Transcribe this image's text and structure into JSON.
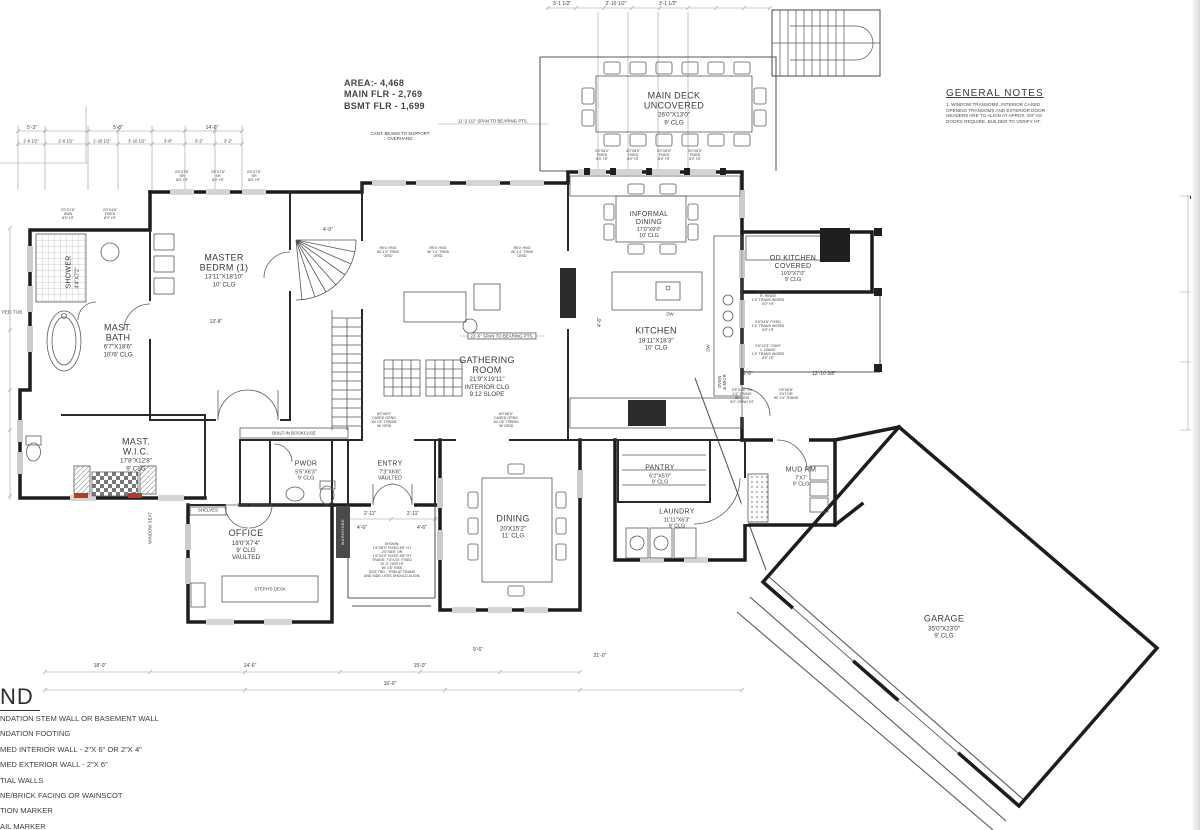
{
  "page": {
    "background": "#ffffff",
    "line_color": "#2e2e2e",
    "accent_red": "#c0392b"
  },
  "area_summary": {
    "text": "AREA:- 4,468\nMAIN FLR - 2,769\nBSMT FLR - 1,699"
  },
  "general_notes": {
    "title": "GENERAL NOTES",
    "items": [
      "1.   WINDOW TRANSOMS, INTERIOR CASED\nOPENING TRANSOMS AND EXTERIOR DOOR\nHEADERS ARE TO ALIGN AT APROX. 8'0\" AS\nDOORS REQUIRE.  BUILDER TO VERIFY HT."
    ]
  },
  "legend": {
    "title": "ND",
    "items": [
      "NDATION STEM WALL OR BASEMENT WALL",
      "NDATION FOOTING",
      "MED INTERIOR WALL - 2\"X 6\" OR 2\"X 4\"",
      "MED EXTERIOR WALL - 2\"X 6\"",
      "TIAL WALLS",
      "NE/BRICK FACING OR WAINSCOT",
      "TION MARKER",
      "AIL MARKER",
      "S SENSOR AND POWERED VENT"
    ]
  },
  "rooms": [
    {
      "id": "master-bedrm",
      "name": "MASTER\nBEDRM (1)",
      "sub": "13'11\"X18'10\"\n10' CLG"
    },
    {
      "id": "shower",
      "name": "SHOWER",
      "sub": "4'4\"X7'2\""
    },
    {
      "id": "mast-bath",
      "name": "MAST.\nBATH",
      "sub": "6'7\"X18'6\"\n10'/9' CLG"
    },
    {
      "id": "mast-wic",
      "name": "MAST.\nW.I.C.",
      "sub": "17'8\"X12'8\"\n9' CLG"
    },
    {
      "id": "office",
      "name": "OFFICE",
      "sub": "18'0\"X7'4\"\n9' CLG\nVAULTED"
    },
    {
      "id": "pwdr",
      "name": "PWDR",
      "sub": "5'5\"X6'3\"\n9' CLG"
    },
    {
      "id": "entry",
      "name": "ENTRY",
      "sub": "7'3\"X6'8\"\nVAULTED"
    },
    {
      "id": "gathering-room",
      "name": "GATHERING\nROOM",
      "sub": "21'9\"X19'11\"\nINTERIOR CLG\n9:12 SLOPE"
    },
    {
      "id": "dining",
      "name": "DINING",
      "sub": "20'X15'2\"\n11' CLG"
    },
    {
      "id": "kitchen",
      "name": "KITCHEN",
      "sub": "18'11\"X18'3\"\n10' CLG"
    },
    {
      "id": "informal-dining",
      "name": "INFORMAL\nDINING",
      "sub": "17'0\"X9'0\"\n10' CLG"
    },
    {
      "id": "main-deck",
      "name": "MAIN DECK\nUNCOVERED",
      "sub": "26'0\"X13'0\"\n9' CLG"
    },
    {
      "id": "od-kitchen",
      "name": "OD KITCHEN\nCOVERED",
      "sub": "10'0\"X7'0\"\n9' CLG"
    },
    {
      "id": "pantry",
      "name": "PANTRY",
      "sub": "6'2\"X5'0\"\n9' CLG"
    },
    {
      "id": "laundry",
      "name": "LAUNDRY",
      "sub": "11'11\"X6'3\"\n9' CLG"
    },
    {
      "id": "mud-rm",
      "name": "MUD RM",
      "sub": "7'X7'\n9' CLG"
    },
    {
      "id": "garage",
      "name": "GARAGE",
      "sub": "35'0\"X23'0\"\n9' CLG"
    }
  ],
  "notes": [
    {
      "text": "CANT. BEAMS TO SUPPORT\nOVERHANG"
    },
    {
      "text": "11'-2 1/2\" SPAN TO BEARING PTS."
    },
    {
      "text": "22'-6\" SPAN TO BEARING PTS."
    },
    {
      "text": "BUILT-IN BOOKCASE"
    },
    {
      "text": "STEPH'S DESK"
    },
    {
      "text": "SHELVES"
    },
    {
      "text": "PED. TUB"
    },
    {
      "text": "WINDOW SEAT"
    },
    {
      "text": "WARDROBE"
    },
    {
      "text": "DW"
    },
    {
      "text": "DW"
    },
    {
      "text": "OVEN\n& MICR"
    },
    {
      "text": "REV. HNG\nW/ 1'4\" TRNS\nGRID"
    },
    {
      "text": "REV. HNG\nW/ 1'4\" TRNS\nGRID"
    },
    {
      "text": "REV. HNG\nW/ 1'4\" TRNS\nGRID"
    },
    {
      "text": "8'0\"X8'0\"\nCASED OPNG\nW/ 1'6\" TRNSM\nW/ GRID"
    },
    {
      "text": "8'0\"X8'0\"\nCASED OPNG\nW/ 1'6\" TRNSM\nW/ GRID"
    },
    {
      "text": "3'0\"X8'0\"\nFIXED\n8'0\" HT"
    },
    {
      "text": "3'0\"X8'0\"\nFIXED\n8'0\" HT"
    },
    {
      "text": "3'0\"X8'0\"\nFIXED\n8'0\" HT"
    },
    {
      "text": "3'0\"X8'0\"\nFIXED\n8'0\" HT"
    },
    {
      "text": "2'6\"X7'6\"\nSH\n8'0\" HT"
    },
    {
      "text": "2'6\"X7'6\"\nSH\n8'0\" HT"
    },
    {
      "text": "2'6\"X7'6\"\nSH\n8'0\" HT"
    },
    {
      "text": "2'0\"X1'6\"\nAWN\n8'0\" HT"
    },
    {
      "text": "2'0\"X4'6\"\nFIXED\n8'0\" HT"
    },
    {
      "text": "2'6\"X6'0\" CSMT\nR. HINGE\n1'4\" TRANS W/GRD\n8'0\" HT"
    },
    {
      "text": "2'6\"X4'6\" FIXED\n1'4\" TRANS W/GRD\n8'0\" HT"
    },
    {
      "text": "2'6\"X2'3\" CSMT\nL. HINGE\n1'4\" TRANS W/GRD\n8'0\" HT"
    },
    {
      "text": "2'6\"X4'6\" SH\n1'4\" TRANS\nW/ GRID\n8'0\" OPNG HT"
    },
    {
      "text": "2'6\"X6'8\"\nEXT DR\nW/ 1'4\" TRANS"
    },
    {
      "text": "SHOWN:\n1'6\"X8'0\" FIXED 8'8\" HT\n2'6\"X8'8\" OR\n1'6\"X4'0\" FIXED 8'8\" HT\nTRANS: 7'4\"X3'0\" FIXED\n10'-0\" HDR HT\nW/ 1'6\" RISE\nSIZE TBD - TRIM AT TRANS\nAND SIDE LITES SHOULD ALIGN."
    }
  ],
  "dims": [
    {
      "text": "5'-3\""
    },
    {
      "text": "5'-8\""
    },
    {
      "text": "14'-0\""
    },
    {
      "text": "2'-6 1/2\""
    },
    {
      "text": "2'-6 1/2\""
    },
    {
      "text": "1'-10 1/2\""
    },
    {
      "text": "3'-10 1/2\""
    },
    {
      "text": "3'-8\""
    },
    {
      "text": "3'-2\""
    },
    {
      "text": "3'-2\""
    },
    {
      "text": "3'-1 1/2\""
    },
    {
      "text": "2'-10 1/2\""
    },
    {
      "text": "3'-1 1/2\""
    },
    {
      "text": "2'-11\""
    },
    {
      "text": "2'-11\""
    },
    {
      "text": "4'-6\""
    },
    {
      "text": "4'-6\""
    },
    {
      "text": "12'-10 3/8\""
    },
    {
      "text": "2'-0\""
    },
    {
      "text": "13'-8\""
    },
    {
      "text": "18'-0\""
    },
    {
      "text": "14'-6\""
    },
    {
      "text": "15'-0\""
    },
    {
      "text": "21'-0\""
    },
    {
      "text": "9'-6\""
    },
    {
      "text": "4'-0\""
    },
    {
      "text": "4'-6\""
    },
    {
      "text": "16'-0\""
    }
  ]
}
